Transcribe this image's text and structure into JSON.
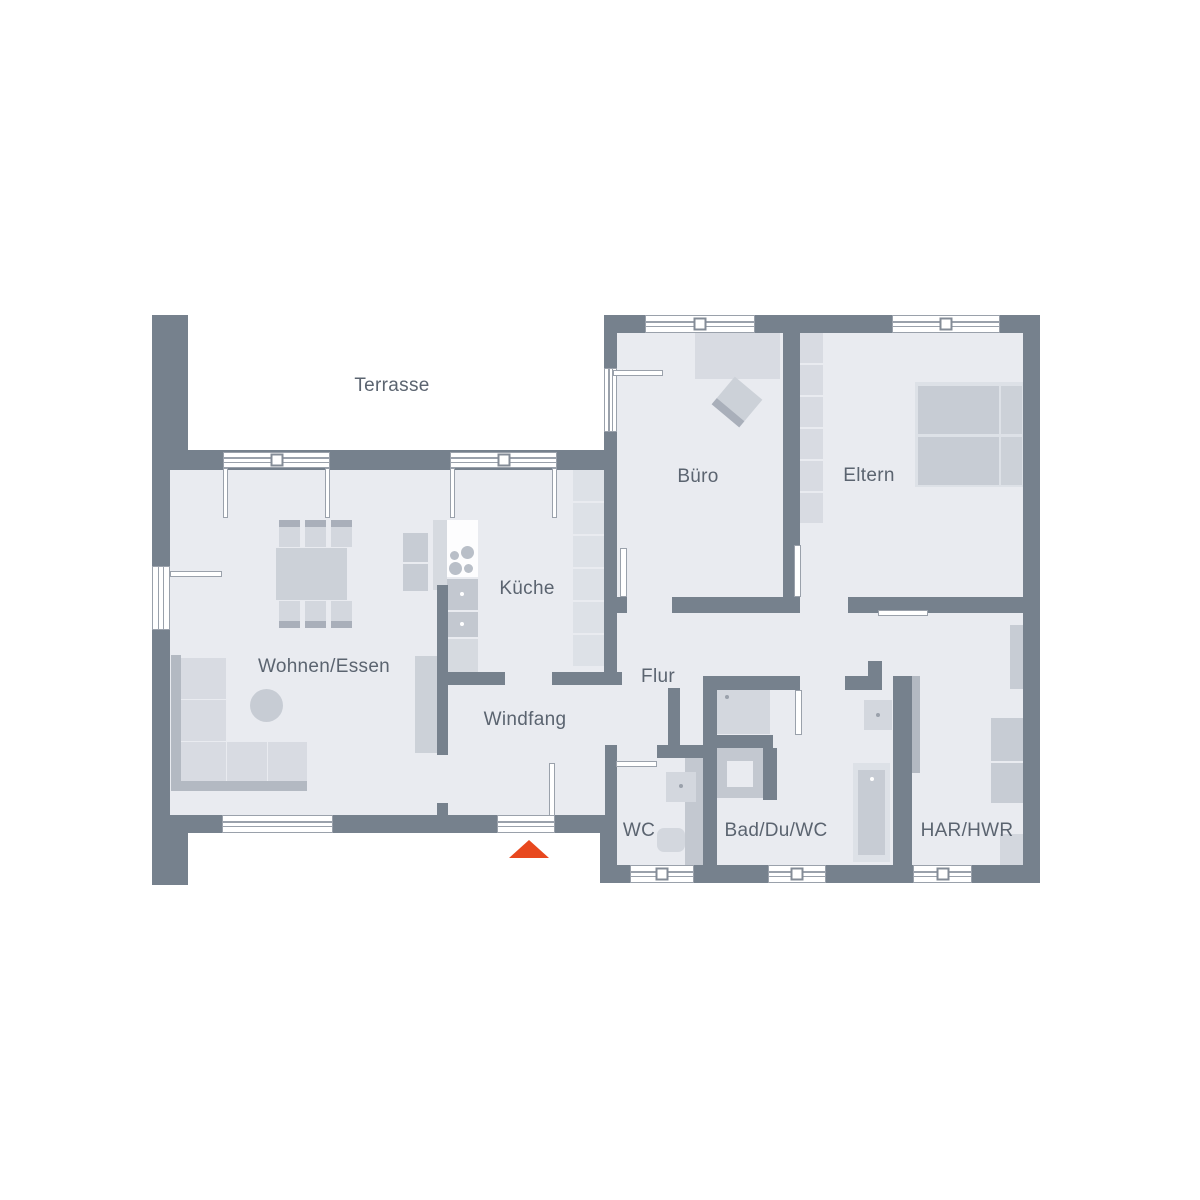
{
  "meta": {
    "title": "Erdgeschoss Grundriss",
    "type": "floor-plan"
  },
  "colors": {
    "wall": "#76818d",
    "floor": "#e9ebf0",
    "line": "#8d949f",
    "frame": "#9aa1ab",
    "text": "#5b6470",
    "white": "#ffffff",
    "furnLight": "#d8dbe2",
    "furnPale": "#dde1e7",
    "furnMid": "#c7ccd4",
    "furnMid2": "#ccd1d8",
    "furnSeat": "#d3d7de",
    "furnDark": "#b3b9c2",
    "furnBar": "#a9afba",
    "appliance": "#c3c8d0",
    "counter": "#d6dae0",
    "stoveTop": "#fdfdfe",
    "burner": "#b9bfc8",
    "accent": "#e8481e"
  },
  "labels": [
    {
      "id": "terrasse",
      "text": "Terrasse",
      "x": 392,
      "y": 386
    },
    {
      "id": "buero",
      "text": "Büro",
      "x": 698,
      "y": 477
    },
    {
      "id": "eltern",
      "text": "Eltern",
      "x": 869,
      "y": 476
    },
    {
      "id": "kueche",
      "text": "Küche",
      "x": 527,
      "y": 589
    },
    {
      "id": "wohnen-essen",
      "text": "Wohnen/Essen",
      "x": 324,
      "y": 667
    },
    {
      "id": "flur",
      "text": "Flur",
      "x": 658,
      "y": 677
    },
    {
      "id": "windfang",
      "text": "Windfang",
      "x": 525,
      "y": 720
    },
    {
      "id": "wc",
      "text": "WC",
      "x": 639,
      "y": 831
    },
    {
      "id": "bad-du-wc",
      "text": "Bad/Du/WC",
      "x": 776,
      "y": 831
    },
    {
      "id": "har-hwr",
      "text": "HAR/HWR",
      "x": 967,
      "y": 831
    }
  ],
  "entrance_marker": {
    "x": 509,
    "y": 840,
    "half_width": 20,
    "height": 18
  },
  "plan": {
    "floors": [
      [
        170,
        470,
        447,
        345
      ],
      [
        617,
        333,
        406,
        264
      ],
      [
        617,
        597,
        406,
        268
      ]
    ],
    "walls": [
      [
        152,
        315,
        36,
        140
      ],
      [
        152,
        455,
        18,
        360
      ],
      [
        152,
        815,
        36,
        70
      ],
      [
        152,
        450,
        461,
        20
      ],
      [
        152,
        815,
        465,
        18
      ],
      [
        600,
        815,
        17,
        68
      ],
      [
        600,
        865,
        440,
        18
      ],
      [
        1023,
        315,
        17,
        568
      ],
      [
        604,
        315,
        436,
        18
      ],
      [
        604,
        333,
        13,
        352
      ],
      [
        783,
        333,
        17,
        264
      ],
      [
        604,
        597,
        23,
        16
      ],
      [
        672,
        597,
        128,
        16
      ],
      [
        848,
        597,
        175,
        16
      ],
      [
        868,
        661,
        14,
        29
      ],
      [
        703,
        676,
        97,
        14
      ],
      [
        845,
        676,
        23,
        14
      ],
      [
        703,
        690,
        14,
        175
      ],
      [
        605,
        745,
        12,
        13
      ],
      [
        657,
        745,
        46,
        13
      ],
      [
        605,
        758,
        12,
        57
      ],
      [
        668,
        688,
        12,
        57
      ],
      [
        437,
        672,
        68,
        13
      ],
      [
        552,
        672,
        70,
        13
      ],
      [
        437,
        585,
        11,
        170
      ],
      [
        437,
        803,
        11,
        14
      ],
      [
        893,
        676,
        19,
        189
      ],
      [
        703,
        735,
        70,
        13
      ],
      [
        763,
        748,
        14,
        52
      ]
    ],
    "windows": [
      {
        "n": "terrace-door-unit-1",
        "r": [
          223,
          452,
          107,
          16
        ],
        "o": "h",
        "sq": true
      },
      {
        "n": "terrace-door-unit-2",
        "r": [
          450,
          452,
          107,
          16
        ],
        "o": "h",
        "sq": true
      },
      {
        "n": "buero-window",
        "r": [
          645,
          315,
          110,
          18
        ],
        "o": "h",
        "sq": true
      },
      {
        "n": "eltern-window",
        "r": [
          892,
          315,
          108,
          18
        ],
        "o": "h",
        "sq": true
      },
      {
        "n": "wohnen-window",
        "r": [
          222,
          815,
          111,
          18
        ],
        "o": "h",
        "sq": false
      },
      {
        "n": "entrance-sill",
        "r": [
          497,
          815,
          58,
          18
        ],
        "o": "h",
        "sq": false
      },
      {
        "n": "wc-window",
        "r": [
          630,
          865,
          64,
          18
        ],
        "o": "h",
        "sq": true
      },
      {
        "n": "bad-window",
        "r": [
          768,
          865,
          58,
          18
        ],
        "o": "h",
        "sq": true
      },
      {
        "n": "har-window",
        "r": [
          913,
          865,
          59,
          18
        ],
        "o": "h",
        "sq": true
      },
      {
        "n": "wohnen-side-door",
        "r": [
          152,
          566,
          18,
          64
        ],
        "o": "v",
        "sq": false
      },
      {
        "n": "buero-terrace-door",
        "r": [
          604,
          368,
          13,
          64
        ],
        "o": "v",
        "sq": false
      }
    ],
    "doors": [
      {
        "n": "wohnen-side-door-leaf",
        "leaf": [
          170,
          571,
          52,
          6
        ],
        "arc": {
          "cx": 171,
          "cy": 574,
          "r": 51,
          "a0": 0,
          "a1": 90,
          "sweep": 1
        }
      },
      {
        "n": "terrace-door-1-left",
        "leaf": [
          223,
          468,
          5,
          50
        ],
        "arc": {
          "cx": 225,
          "cy": 470,
          "r": 48,
          "a0": 0,
          "a1": 90,
          "sweep": 1
        }
      },
      {
        "n": "terrace-door-1-right",
        "leaf": [
          325,
          468,
          5,
          50
        ],
        "arc": {
          "cx": 328,
          "cy": 470,
          "r": 48,
          "a0": 90,
          "a1": 180,
          "sweep": 1
        }
      },
      {
        "n": "terrace-door-2-left",
        "leaf": [
          450,
          468,
          5,
          50
        ],
        "arc": {
          "cx": 452,
          "cy": 470,
          "r": 49,
          "a0": 0,
          "a1": 90,
          "sweep": 1
        }
      },
      {
        "n": "terrace-door-2-right",
        "leaf": [
          552,
          468,
          5,
          50
        ],
        "arc": {
          "cx": 555,
          "cy": 470,
          "r": 49,
          "a0": 90,
          "a1": 180,
          "sweep": 1
        }
      },
      {
        "n": "buero-terrace-door-leaf",
        "leaf": [
          613,
          370,
          50,
          6
        ],
        "arc": {
          "cx": 614,
          "cy": 372,
          "r": 53,
          "a0": 0,
          "a1": 90,
          "sweep": 1
        }
      },
      {
        "n": "buero-door",
        "leaf": [
          620,
          548,
          7,
          49
        ],
        "arc": {
          "cx": 626,
          "cy": 597,
          "r": 47,
          "a0": 270,
          "a1": 360,
          "sweep": 1
        }
      },
      {
        "n": "eltern-door",
        "leaf": [
          794,
          545,
          7,
          52
        ],
        "arc": {
          "cx": 800,
          "cy": 597,
          "r": 47,
          "a0": 270,
          "a1": 360,
          "sweep": 1
        }
      },
      {
        "n": "bad-door",
        "leaf": [
          795,
          690,
          7,
          45
        ],
        "arc": {
          "cx": 799,
          "cy": 690,
          "r": 45,
          "a0": 90,
          "a1": 0,
          "sweep": 0
        }
      },
      {
        "n": "har-door",
        "leaf": [
          878,
          610,
          50,
          6
        ],
        "arc": {
          "cx": 880,
          "cy": 614,
          "r": 50,
          "a0": 0,
          "a1": 90,
          "sweep": 1
        }
      },
      {
        "n": "wc-door",
        "leaf": [
          616,
          761,
          41,
          6
        ],
        "arc": {
          "cx": 618,
          "cy": 764,
          "r": 42,
          "a0": 0,
          "a1": 90,
          "sweep": 1
        }
      },
      {
        "n": "entrance-door",
        "leaf": [
          549,
          763,
          6,
          53
        ],
        "arc": {
          "cx": 552,
          "cy": 816,
          "r": 52,
          "a0": 270,
          "a1": 180,
          "sweep": 0
        }
      }
    ],
    "furniture": [
      {
        "n": "sofa-back-left",
        "r": [
          171,
          655,
          10,
          136
        ],
        "c": "furnDark"
      },
      {
        "n": "sofa-back-bottom",
        "r": [
          171,
          781,
          136,
          10
        ],
        "c": "furnDark"
      },
      {
        "n": "sofa-cushion",
        "r": [
          181,
          658,
          45,
          41
        ],
        "c": "furnLight"
      },
      {
        "n": "sofa-cushion",
        "r": [
          181,
          700,
          45,
          41
        ],
        "c": "furnLight"
      },
      {
        "n": "sofa-cushion",
        "r": [
          181,
          742,
          45,
          39
        ],
        "c": "furnLight"
      },
      {
        "n": "sofa-cushion",
        "r": [
          227,
          742,
          40,
          39
        ],
        "c": "furnLight"
      },
      {
        "n": "sofa-cushion",
        "r": [
          268,
          742,
          39,
          39
        ],
        "c": "furnLight"
      },
      {
        "n": "coffee-table",
        "r": [
          250,
          689,
          33,
          33
        ],
        "c": "furnMid",
        "round": true
      },
      {
        "n": "tv-board",
        "r": [
          415,
          656,
          22,
          97
        ],
        "c": "furnMid2"
      },
      {
        "n": "dining-table",
        "r": [
          276,
          548,
          71,
          52
        ],
        "c": "furnMid2"
      },
      {
        "n": "dining-chair",
        "r": [
          279,
          520,
          21,
          27
        ],
        "c": "furnSeat",
        "bar": {
          "side": "top",
          "h": 7
        }
      },
      {
        "n": "dining-chair",
        "r": [
          305,
          520,
          21,
          27
        ],
        "c": "furnSeat",
        "bar": {
          "side": "top",
          "h": 7
        }
      },
      {
        "n": "dining-chair",
        "r": [
          331,
          520,
          21,
          27
        ],
        "c": "furnSeat",
        "bar": {
          "side": "top",
          "h": 7
        }
      },
      {
        "n": "dining-chair",
        "r": [
          279,
          601,
          21,
          27
        ],
        "c": "furnSeat",
        "bar": {
          "side": "bottom",
          "h": 7
        }
      },
      {
        "n": "dining-chair",
        "r": [
          305,
          601,
          21,
          27
        ],
        "c": "furnSeat",
        "bar": {
          "side": "bottom",
          "h": 7
        }
      },
      {
        "n": "dining-chair",
        "r": [
          331,
          601,
          21,
          27
        ],
        "c": "furnSeat",
        "bar": {
          "side": "bottom",
          "h": 7
        }
      },
      {
        "n": "kitchen-side-panel",
        "r": [
          433,
          520,
          14,
          70
        ],
        "c": "counter"
      },
      {
        "n": "kitchen-counter",
        "r": [
          447,
          520,
          31,
          23
        ],
        "c": "stoveTop"
      },
      {
        "n": "stove",
        "r": [
          447,
          543,
          31,
          34
        ],
        "c": "stoveTop",
        "dots": [
          {
            "dx": 3,
            "dy": 8,
            "d": 9,
            "c": "burner"
          },
          {
            "dx": 14,
            "dy": 3,
            "d": 13,
            "c": "burner"
          },
          {
            "dx": 2,
            "dy": 19,
            "d": 13,
            "c": "burner"
          },
          {
            "dx": 17,
            "dy": 21,
            "d": 9,
            "c": "burner"
          }
        ]
      },
      {
        "n": "oven",
        "r": [
          447,
          579,
          31,
          31
        ],
        "c": "appliance",
        "dots": [
          {
            "dx": 13,
            "dy": 13,
            "d": 4,
            "c": "white"
          }
        ]
      },
      {
        "n": "oven",
        "r": [
          447,
          612,
          31,
          25
        ],
        "c": "appliance",
        "dots": [
          {
            "dx": 13,
            "dy": 10,
            "d": 4,
            "c": "white"
          }
        ]
      },
      {
        "n": "kitchen-counter",
        "r": [
          447,
          639,
          31,
          33
        ],
        "c": "counter"
      },
      {
        "n": "kitchen-island",
        "r": [
          403,
          533,
          25,
          29
        ],
        "c": "furnMid"
      },
      {
        "n": "kitchen-island",
        "r": [
          403,
          564,
          25,
          27
        ],
        "c": "furnMid"
      },
      {
        "n": "kitchen-tall-cabinets",
        "r": [
          573,
          470,
          31,
          196
        ],
        "c": "furnPale",
        "seg": {
          "p": 33,
          "gap": 2
        }
      },
      {
        "n": "desk",
        "r": [
          695,
          333,
          85,
          46
        ],
        "c": "furnLight"
      },
      {
        "n": "desk-chair",
        "r": [
          719,
          384,
          36,
          36
        ],
        "c": "furnMid2",
        "rot": 40,
        "bar": {
          "side": "bottom",
          "h": 8
        }
      },
      {
        "n": "eltern-closet",
        "r": [
          800,
          333,
          23,
          191
        ],
        "c": "furnLight",
        "seg": {
          "p": 32,
          "gap": 2
        }
      },
      {
        "n": "bed-frame",
        "r": [
          915,
          382,
          108,
          105
        ],
        "c": "furnPale"
      },
      {
        "n": "mattress",
        "r": [
          918,
          386,
          81,
          48
        ],
        "c": "furnMid"
      },
      {
        "n": "mattress",
        "r": [
          918,
          437,
          81,
          48
        ],
        "c": "furnMid"
      },
      {
        "n": "pillow",
        "r": [
          1001,
          386,
          21,
          48
        ],
        "c": "furnMid2"
      },
      {
        "n": "pillow",
        "r": [
          1001,
          437,
          21,
          48
        ],
        "c": "furnMid2"
      },
      {
        "n": "wc-plumbing-wall",
        "r": [
          685,
          752,
          18,
          113
        ],
        "c": "appliance"
      },
      {
        "n": "wc-washbasin",
        "r": [
          666,
          772,
          30,
          30
        ],
        "c": "furnSeat",
        "dots": [
          {
            "dx": 13,
            "dy": 12,
            "d": 4,
            "c": "frame"
          }
        ]
      },
      {
        "n": "wc-toilet",
        "r": [
          657,
          828,
          28,
          24
        ],
        "c": "furnSeat"
      },
      {
        "n": "shower",
        "r": [
          717,
          680,
          53,
          54
        ],
        "c": "furnSeat",
        "dots": [
          {
            "dx": 8,
            "dy": 15,
            "d": 4,
            "c": "frame"
          }
        ]
      },
      {
        "n": "bad-vanity",
        "r": [
          717,
          748,
          46,
          50
        ],
        "c": "appliance",
        "inner": {
          "dx": 10,
          "dy": 13,
          "w": 26,
          "h": 26,
          "c": "floor"
        }
      },
      {
        "n": "bad-washbasin",
        "r": [
          864,
          700,
          28,
          30
        ],
        "c": "furnSeat",
        "dots": [
          {
            "dx": 12,
            "dy": 13,
            "d": 4,
            "c": "frame"
          }
        ]
      },
      {
        "n": "bathtub",
        "r": [
          853,
          763,
          37,
          99
        ],
        "c": "furnPale",
        "inner": {
          "dx": 5,
          "dy": 7,
          "w": 27,
          "h": 85,
          "c": "furnMid"
        },
        "dots": [
          {
            "dx": 17,
            "dy": 14,
            "d": 4,
            "c": "white"
          }
        ]
      },
      {
        "n": "har-wall-shadow",
        "r": [
          912,
          676,
          8,
          97
        ],
        "c": "furnDark"
      },
      {
        "n": "har-cabinet",
        "r": [
          1010,
          625,
          13,
          64
        ],
        "c": "furnMid"
      },
      {
        "n": "washing-machine",
        "r": [
          991,
          718,
          32,
          43
        ],
        "c": "furnMid"
      },
      {
        "n": "dryer",
        "r": [
          991,
          763,
          32,
          40
        ],
        "c": "furnMid"
      },
      {
        "n": "har-corner-unit",
        "r": [
          1000,
          834,
          23,
          31
        ],
        "c": "furnSeat"
      }
    ]
  }
}
